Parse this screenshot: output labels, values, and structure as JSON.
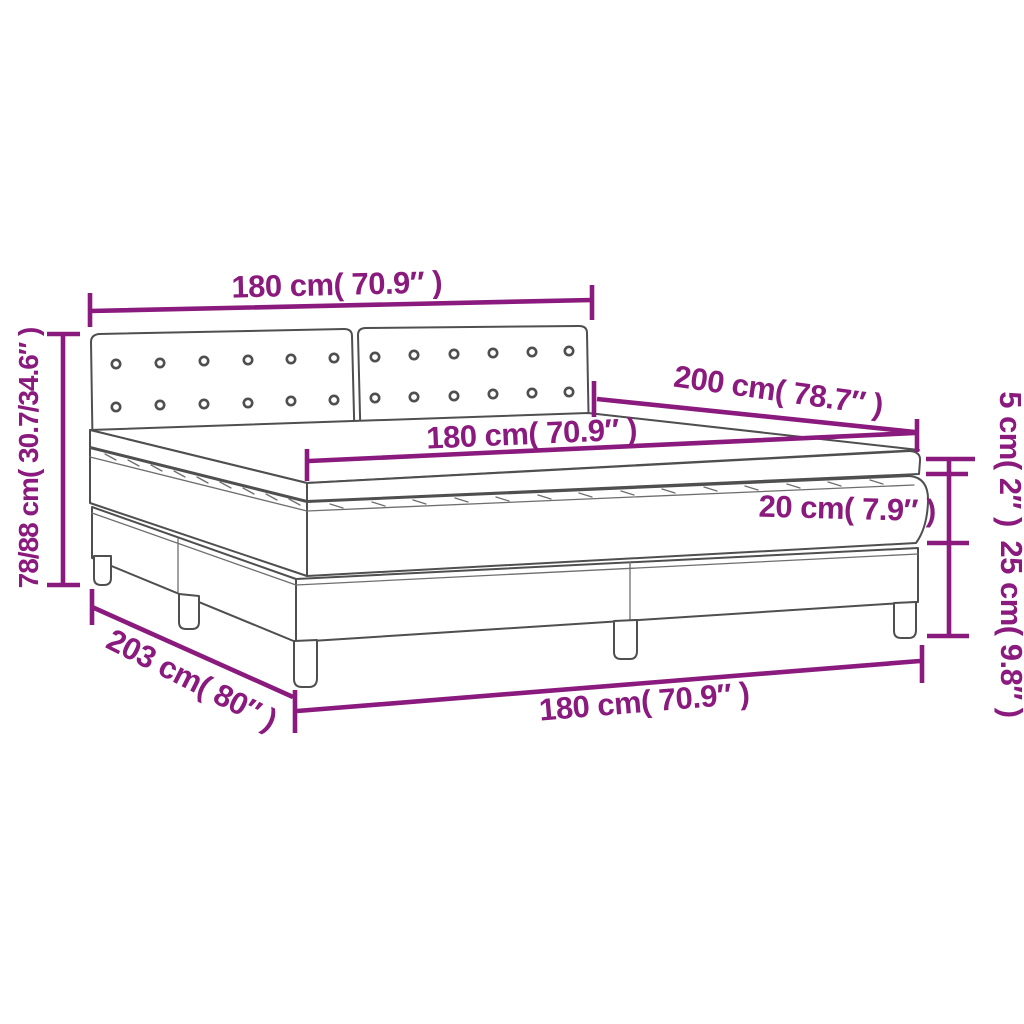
{
  "diagram": {
    "title": "box-spring-bed-dimension-diagram",
    "colors": {
      "accent": "#8A1A7D",
      "line": "#4F4F4F",
      "thin_line": "#6E6E6E",
      "background": "#FFFFFF"
    },
    "labels": {
      "headboard_width": "180 cm( 70.9″ )",
      "bed_length": "200 cm( 78.7″ )",
      "mattress_width": "180 cm( 70.9″ )",
      "topper_height": "5 cm( 2″ )",
      "mattress_height": "20 cm( 7.9″ )",
      "base_height": "25 cm( 9.8″ )",
      "total_height": "78/88 cm( 30.7/34.6″ )",
      "base_length": "203 cm( 80″ )",
      "base_width": "180 cm( 70.9″ )"
    },
    "headboard_buttons": {
      "panels": 2,
      "rows": 2,
      "buttons_per_row": 6
    }
  }
}
